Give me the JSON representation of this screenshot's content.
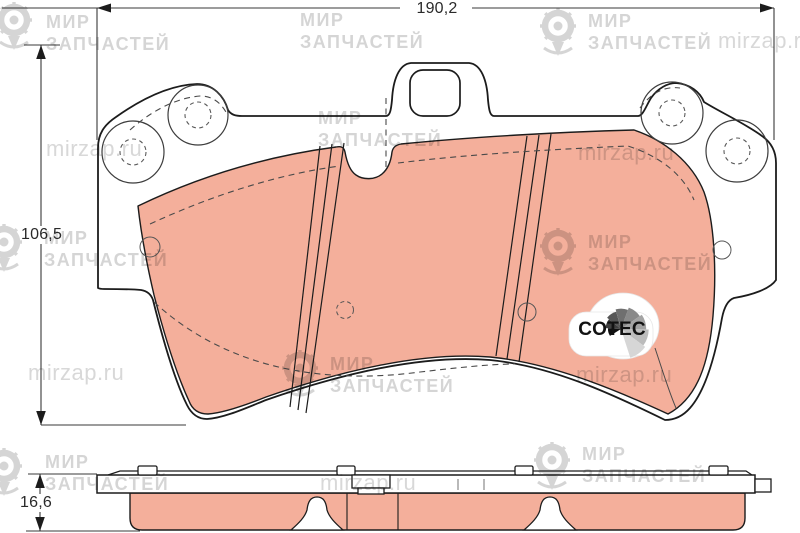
{
  "drawing": {
    "title": "brake pad set technical drawing",
    "dimensions": {
      "width": "190,2",
      "height": "106,5",
      "thickness": "16,6"
    },
    "logo": {
      "text": "COTEC",
      "fan": {
        "cx": 621,
        "cy": 329,
        "start_deg": 212,
        "step_deg": -35.5,
        "r_start": 13,
        "r_step": 2.45
      },
      "fan_colors": [
        "#101010",
        "#3f3f3f",
        "#565656",
        "#6f6f6f",
        "#898989",
        "#a3a3a3",
        "#bcbcbc",
        "#d6d6d6"
      ]
    },
    "colors": {
      "friction": "#f4af9b",
      "outline": "#1c1c1c",
      "dashed": "#4a4a4a",
      "watermark": "#d2d2d2"
    }
  },
  "watermark": {
    "brand_line1": "МИР",
    "brand_line2": "ЗАПЧАСТЕЙ",
    "site": "mirzap.ru",
    "items": [
      {
        "type": "brand",
        "text_x": 46,
        "text_y": 12,
        "icon_x": -6,
        "icon_y": 0
      },
      {
        "type": "brand",
        "text_x": 300,
        "text_y": 10
      },
      {
        "type": "brand",
        "text_x": 588,
        "text_y": 11,
        "icon_x": 538,
        "icon_y": 6
      },
      {
        "type": "site",
        "x": 718,
        "y": 28
      },
      {
        "type": "site",
        "x": 46,
        "y": 136
      },
      {
        "type": "brand",
        "text_x": 318,
        "text_y": 108
      },
      {
        "type": "site",
        "x": 578,
        "y": 140
      },
      {
        "type": "brand",
        "text_x": 44,
        "text_y": 228,
        "icon_x": -16,
        "icon_y": 222
      },
      {
        "type": "brand",
        "text_x": 588,
        "text_y": 232,
        "icon_x": 538,
        "icon_y": 226
      },
      {
        "type": "site",
        "x": 28,
        "y": 360
      },
      {
        "type": "brand",
        "text_x": 330,
        "text_y": 354,
        "icon_x": 280,
        "icon_y": 348
      },
      {
        "type": "site",
        "x": 576,
        "y": 362
      },
      {
        "type": "brand",
        "text_x": 45,
        "text_y": 452,
        "icon_x": -16,
        "icon_y": 446
      },
      {
        "type": "site",
        "x": 320,
        "y": 470
      },
      {
        "type": "brand",
        "text_x": 582,
        "text_y": 444,
        "icon_x": 532,
        "icon_y": 440
      }
    ]
  }
}
